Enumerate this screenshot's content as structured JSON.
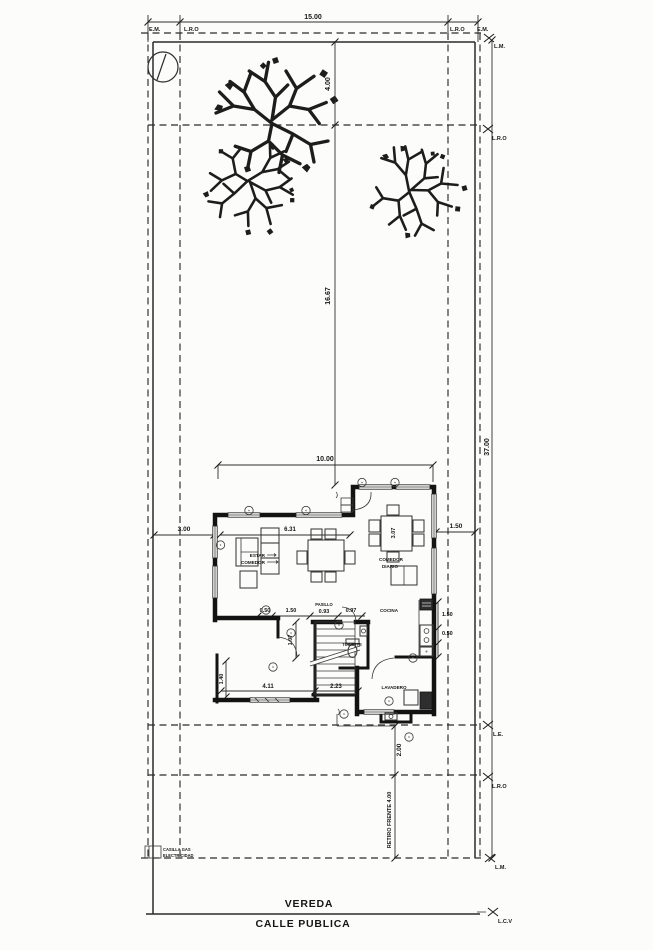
{
  "drawing": {
    "street": {
      "sidewalk": "VEREDA",
      "road": "CALLE PUBLICA"
    },
    "marks": {
      "em_left": "E.M.",
      "lro_left": "L.R.O",
      "lro_right": "L.R.O",
      "em_right": "E.M.",
      "lm_top": "L.M.",
      "lro_side_upper": "L.R.O",
      "le_side": "L.E.",
      "lro_side_lower": "L.R.O",
      "lm_bottom": "L.M.",
      "lcv": "L.C.V"
    },
    "dims": {
      "lot_width": "15.00",
      "front_strip": "4.00",
      "mid_depth": "16.67",
      "lot_depth": "37.00",
      "house_width": "10.00",
      "left_setback": "3.00",
      "right_setback": "1.50",
      "living_width": "6.31",
      "dining_depth": "3.07",
      "seg_050": "0.50",
      "seg_150": "1.50",
      "pasillo_width": "0.93",
      "seg_097": "0.97",
      "kitchen_150": "1.50",
      "kitchen_050": "0.50",
      "hall_107": "1.07",
      "room_411": "4.11",
      "stair_223": "2.23",
      "room_140": "1.40",
      "walk_200": "2.00",
      "retiro": "RETIRO FRENTE 4.00"
    },
    "rooms": {
      "estar": "ESTAR",
      "comedor": "COMEDOR",
      "comedor_diario_1": "COMEDOR",
      "comedor_diario_2": "DIARIO",
      "cocina": "COCINA",
      "pasillo": "PASILLO",
      "toilette": "TOILETTE",
      "lavadero": "LAVADERO"
    },
    "utility": {
      "line1": "CASILLA GAS",
      "line2": "ELECTRICIDAD"
    },
    "colors": {
      "ink": "#1c1c1c",
      "paper": "#fcfcfa"
    }
  }
}
